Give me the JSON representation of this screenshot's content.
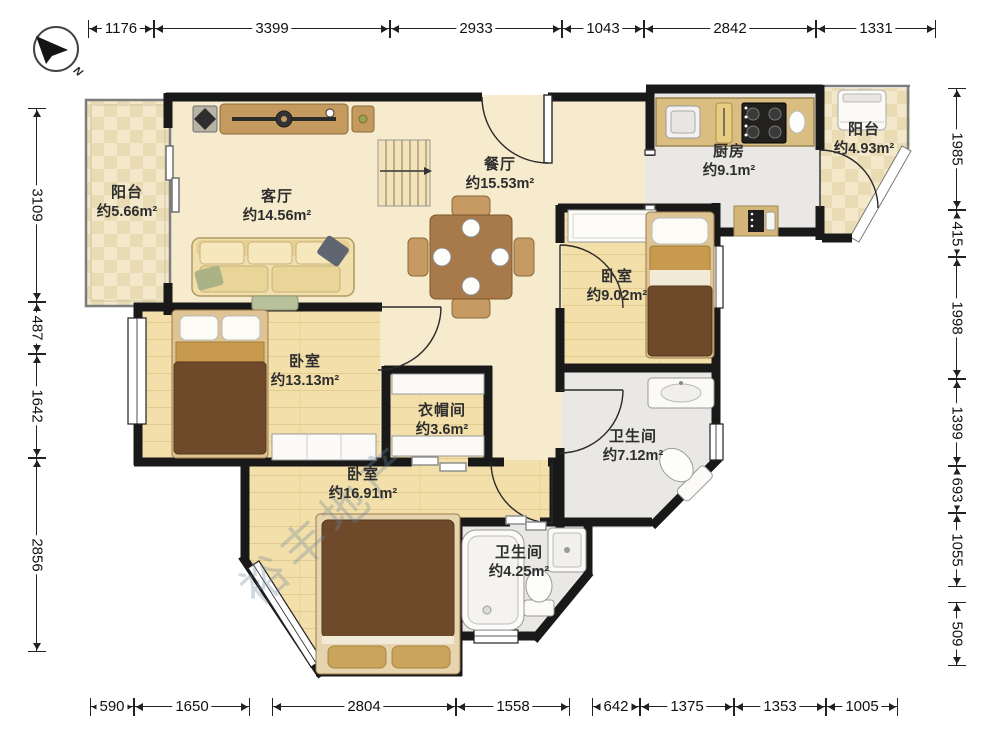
{
  "compass": {
    "north_label": "N"
  },
  "watermark": "裕丰地产",
  "dimensions": {
    "top": [
      "1176",
      "3399",
      "2933",
      "1043",
      "2842",
      "1331"
    ],
    "bottom": [
      "590",
      "1650",
      "2804",
      "1558",
      "642",
      "1375",
      "1353",
      "1005"
    ],
    "left": [
      "3109",
      "487",
      "1642",
      "2856"
    ],
    "right": [
      "1985",
      "415",
      "1998",
      "1399",
      "693",
      "1055",
      "509"
    ]
  },
  "rooms": {
    "balcony_left": {
      "name": "阳台",
      "area": "约5.66m²"
    },
    "living": {
      "name": "客厅",
      "area": "约14.56m²"
    },
    "dining": {
      "name": "餐厅",
      "area": "约15.53m²"
    },
    "kitchen": {
      "name": "厨房",
      "area": "约9.1m²"
    },
    "balcony_right": {
      "name": "阳台",
      "area": "约4.93m²"
    },
    "bedroom_right": {
      "name": "卧室",
      "area": "约9.02m²"
    },
    "bedroom_mid": {
      "name": "卧室",
      "area": "约13.13m²"
    },
    "closet": {
      "name": "衣帽间",
      "area": "约3.6m²"
    },
    "bath_main": {
      "name": "卫生间",
      "area": "约7.12m²"
    },
    "bedroom_bottom": {
      "name": "卧室",
      "area": "约16.91m²"
    },
    "bath_small": {
      "name": "卫生间",
      "area": "约4.25m²"
    }
  },
  "colors": {
    "wall": "#191919",
    "wood_floor": "#f2dfaa",
    "marble_floor": "#f6ebcd",
    "tile_floor": "#f3e9ca",
    "wet_floor": "#eae8e4",
    "furniture_wood": "#c59a5f",
    "blanket": "#6f4a2a"
  }
}
